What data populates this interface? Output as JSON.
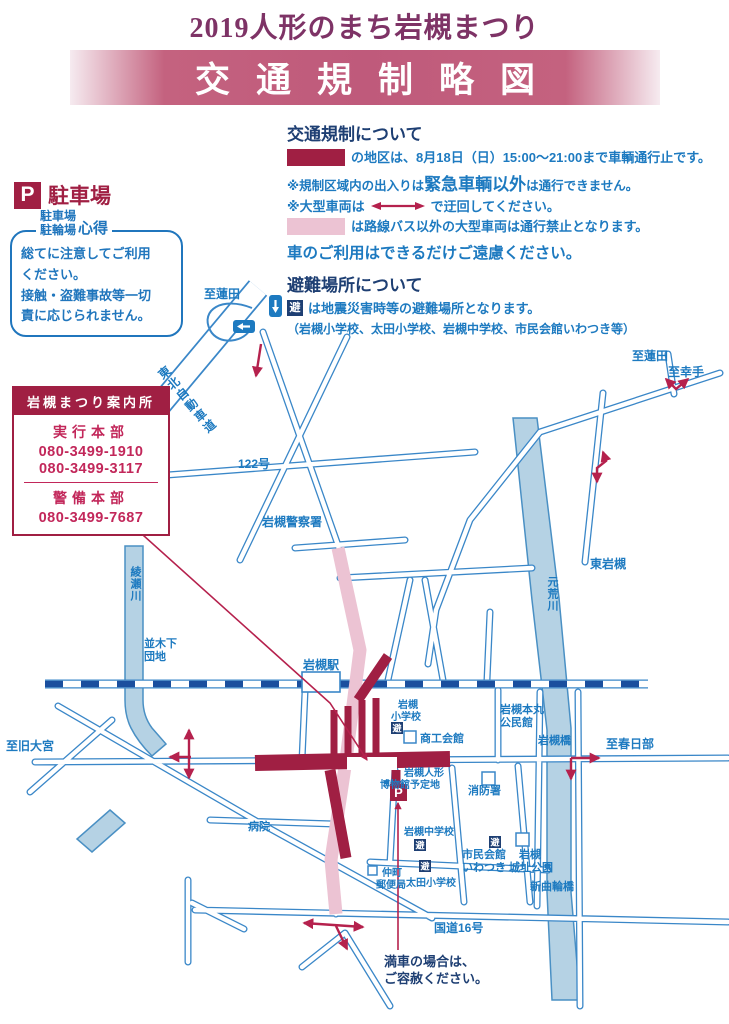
{
  "title": "2019人形のまち岩槻まつり",
  "banner": "交通規制略図",
  "colors": {
    "plum_title": "#7e3366",
    "banner_rose": "#c4627f",
    "crimson": "#a01f43",
    "crimson_bright": "#c2275a",
    "arrow_red": "#b5214d",
    "pink": "#ecc3d3",
    "text_blue": "#1d7ac0",
    "navy": "#1e3f73",
    "map_blue": "#3a87c8",
    "rail_navy": "#1b4f9e",
    "river_fill": "#b5d2e4"
  },
  "legend": {
    "traffic_heading": "交通規制について",
    "line1_text": "の地区は、8月18日（日）15:00～21:00まで車輌通行止です。",
    "line2_pre": "※規制区域内の出入りは",
    "line2_big": "緊急車輌以外",
    "line2_post": "は通行できません。",
    "line3_pre": "※大型車両は",
    "line3_post": "で迂回してください。",
    "line4_text": "は路線バス以外の大型車両は通行禁止となります。",
    "line5": "車のご利用はできるだけご遠慮ください。",
    "evac_heading": "避難場所について",
    "evac_icon": "避",
    "evac_line": "は地震災害時等の避難場所となります。",
    "evac_sub": "（岩槻小学校、太田小学校、岩槻中学校、市民会館いわつき等）"
  },
  "parking": {
    "p_icon": "P",
    "heading": "駐車場",
    "notice_title_1": "駐車場",
    "notice_title_2": "駐輪場",
    "notice_title_3": "心得",
    "notice_body": "総てに注意してご利用\nください。\n接触・盗難事故等一切\n責に応じられません。"
  },
  "info_box": {
    "header": "岩槻まつり案内所",
    "group1_title": "実行本部",
    "phone1": "080-3499-1910",
    "phone2": "080-3499-3117",
    "group2_title": "警備本部",
    "phone3": "080-3499-7687"
  },
  "map": {
    "labels": [
      {
        "t": "至蓮田",
        "x": 204,
        "y": 298,
        "s": 12
      },
      {
        "t": "東北自動車道",
        "x": 160,
        "y": 368,
        "s": 12,
        "v": 1,
        "r": -40,
        "ls": 2
      },
      {
        "t": "122号",
        "x": 238,
        "y": 468,
        "s": 12
      },
      {
        "t": "岩槻警察署",
        "x": 262,
        "y": 526,
        "s": 12
      },
      {
        "t": "至蓮田",
        "x": 632,
        "y": 360,
        "s": 12
      },
      {
        "t": "至幸手",
        "x": 668,
        "y": 376,
        "s": 12
      },
      {
        "t": "東岩槻",
        "x": 590,
        "y": 568,
        "s": 12
      },
      {
        "t": "元荒川",
        "x": 552,
        "y": 576,
        "s": 11,
        "v": 1
      },
      {
        "t": "綾瀬川",
        "x": 135,
        "y": 566,
        "s": 11,
        "v": 1
      },
      {
        "t": "並木下",
        "x": 144,
        "y": 647,
        "s": 11
      },
      {
        "t": "団地",
        "x": 144,
        "y": 660,
        "s": 11
      },
      {
        "t": "岩槻駅",
        "x": 303,
        "y": 669,
        "s": 12
      },
      {
        "t": "至旧大宮",
        "x": 6,
        "y": 750,
        "s": 12
      },
      {
        "t": "岩槻",
        "x": 398,
        "y": 708,
        "s": 10
      },
      {
        "t": "小学校",
        "x": 391,
        "y": 720,
        "s": 10
      },
      {
        "t": "商工会館",
        "x": 420,
        "y": 742,
        "s": 11
      },
      {
        "t": "岩槻本丸",
        "x": 500,
        "y": 713,
        "s": 11
      },
      {
        "t": "公民館",
        "x": 500,
        "y": 726,
        "s": 11
      },
      {
        "t": "岩槻橋",
        "x": 538,
        "y": 744,
        "s": 11
      },
      {
        "t": "至春日部",
        "x": 606,
        "y": 748,
        "s": 12
      },
      {
        "t": "岩槻人形",
        "x": 404,
        "y": 776,
        "s": 10
      },
      {
        "t": "博物館予定地",
        "x": 380,
        "y": 788,
        "s": 10
      },
      {
        "t": "消防署",
        "x": 468,
        "y": 794,
        "s": 11
      },
      {
        "t": "岩槻中学校",
        "x": 404,
        "y": 835,
        "s": 10
      },
      {
        "t": "市民会館",
        "x": 462,
        "y": 858,
        "s": 11
      },
      {
        "t": "いわつき",
        "x": 462,
        "y": 871,
        "s": 11
      },
      {
        "t": "岩槻",
        "x": 519,
        "y": 858,
        "s": 11
      },
      {
        "t": "城址公園",
        "x": 509,
        "y": 871,
        "s": 11
      },
      {
        "t": "病院",
        "x": 248,
        "y": 830,
        "s": 11
      },
      {
        "t": "仲町",
        "x": 382,
        "y": 876,
        "s": 10
      },
      {
        "t": "郵便局",
        "x": 376,
        "y": 888,
        "s": 10
      },
      {
        "t": "太田小学校",
        "x": 406,
        "y": 886,
        "s": 10
      },
      {
        "t": "国道16号",
        "x": 434,
        "y": 932,
        "s": 12
      },
      {
        "t": "新曲輪橋",
        "x": 530,
        "y": 890,
        "s": 11
      },
      {
        "t": "満車の場合は、",
        "x": 384,
        "y": 966,
        "s": 13,
        "c": "navy"
      },
      {
        "t": "ご容赦ください。",
        "x": 384,
        "y": 983,
        "s": 13,
        "c": "navy"
      }
    ],
    "evac_icon_char": "避",
    "evac_icons": [
      {
        "x": 391,
        "y": 722
      },
      {
        "x": 414,
        "y": 839
      },
      {
        "x": 419,
        "y": 860
      },
      {
        "x": 489,
        "y": 836
      }
    ],
    "building_squares": [
      {
        "x": 404,
        "y": 731,
        "s": 12
      },
      {
        "x": 516,
        "y": 833,
        "s": 13
      },
      {
        "x": 368,
        "y": 866,
        "s": 9
      },
      {
        "x": 482,
        "y": 772,
        "s": 13
      }
    ],
    "p_marker": {
      "x": 390,
      "y": 784,
      "s": 17,
      "label": "P"
    },
    "oneway_signs": [
      {
        "x": 269,
        "y": 295,
        "d": "down"
      },
      {
        "x": 233,
        "y": 320,
        "d": "left"
      }
    ],
    "arrows": [
      {
        "pts": [
          [
            261,
            344
          ],
          [
            256,
            376
          ]
        ],
        "heads": "end"
      },
      {
        "pts": [
          [
            666,
            379
          ],
          [
            676,
            389
          ],
          [
            688,
            379
          ]
        ],
        "heads": "both"
      },
      {
        "pts": [
          [
            603,
            452
          ],
          [
            606,
            461
          ],
          [
            597,
            468
          ],
          [
            597,
            482
          ]
        ],
        "heads": "both"
      },
      {
        "pts": [
          [
            189,
            730
          ],
          [
            189,
            778
          ]
        ],
        "heads": "both"
      },
      {
        "pts": [
          [
            191,
            757
          ],
          [
            170,
            757
          ]
        ],
        "heads": "end"
      },
      {
        "pts": [
          [
            571,
            758
          ],
          [
            599,
            758
          ]
        ],
        "heads": "end"
      },
      {
        "pts": [
          [
            571,
            758
          ],
          [
            571,
            779
          ]
        ],
        "heads": "end"
      },
      {
        "pts": [
          [
            304,
            923
          ],
          [
            363,
            927
          ]
        ],
        "heads": "both"
      },
      {
        "pts": [
          [
            336,
            926
          ],
          [
            347,
            949
          ]
        ],
        "heads": "end"
      }
    ],
    "leaders": [
      {
        "pts": [
          [
            95,
            492
          ],
          [
            330,
            703
          ],
          [
            367,
            760
          ]
        ],
        "heads": "end"
      },
      {
        "pts": [
          [
            398,
            950
          ],
          [
            398,
            803
          ]
        ],
        "heads": "end"
      }
    ]
  }
}
